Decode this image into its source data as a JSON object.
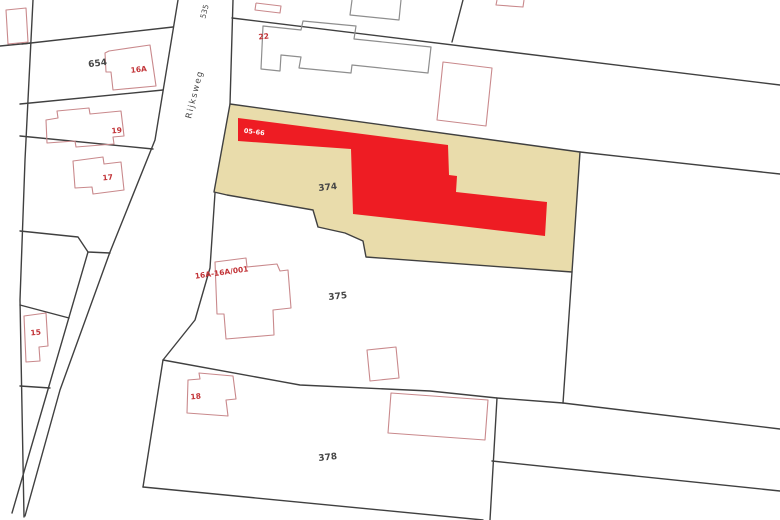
{
  "map_type": "cadastral-parcel-map",
  "road": {
    "name": "Rijksweg",
    "number": "535"
  },
  "highlighted_parcel": "374",
  "labels": {
    "road_name": "Rijksweg",
    "road_number": "535",
    "parcel_654": "654",
    "parcel_374": "374",
    "parcel_375": "375",
    "parcel_378": "378",
    "house_16a": "16A",
    "house_22": "22",
    "house_19": "19",
    "house_17": "17",
    "house_15": "15",
    "house_18": "18",
    "house_16a_001": "16A-16A/001",
    "subject_building": "05-66"
  },
  "colors": {
    "background": "#ffffff",
    "parcel_highlight_fill": "#e9dcab",
    "subject_building_fill": "#ee1c23",
    "boundary_line": "#404040",
    "building_outline_red": "#c9898c",
    "building_outline_gray": "#8e8e8e",
    "address_label_red": "#c23337",
    "parcel_label_gray": "#474747",
    "subject_label_white": "#ffffff"
  }
}
